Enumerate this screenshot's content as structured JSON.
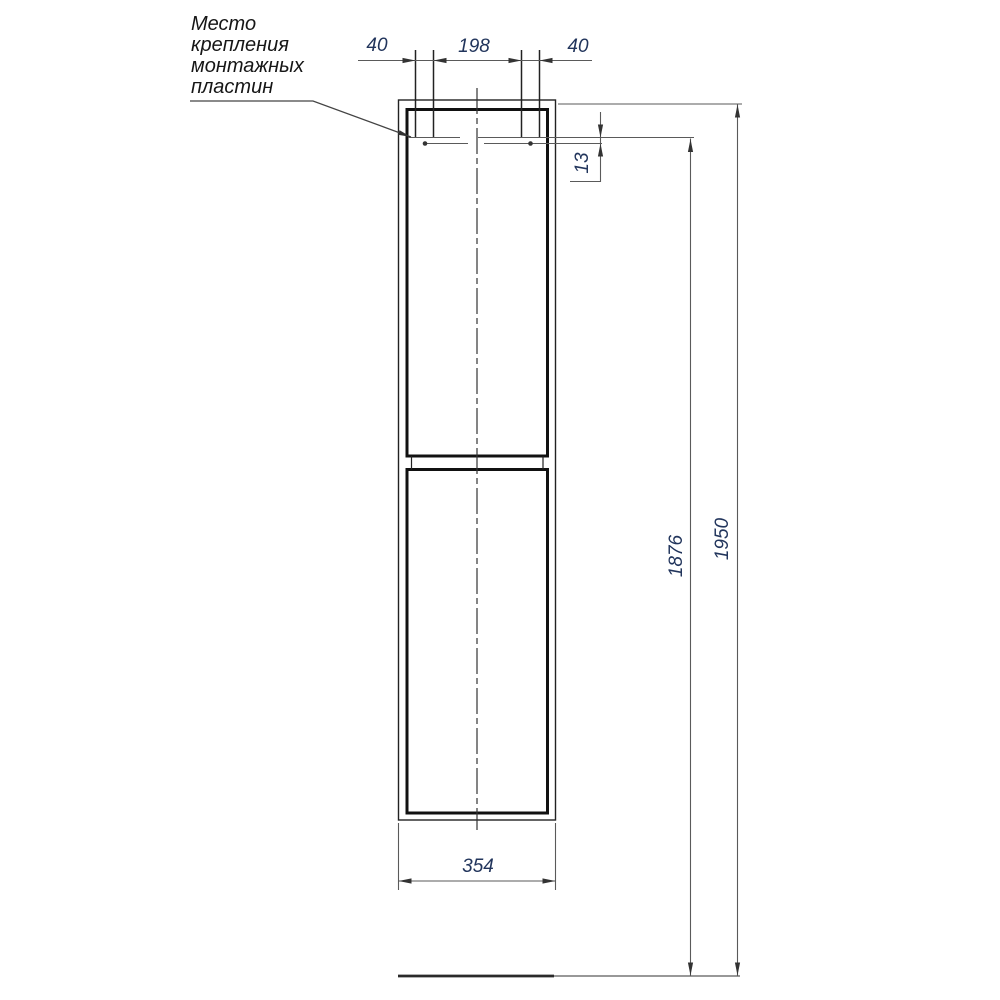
{
  "title": "Cabinet mounting technical drawing",
  "note": {
    "text": "Место\nкрепления\nмонтажных\nпластин"
  },
  "dimensions": {
    "plate_left_width": "40",
    "plate_spacing": "198",
    "plate_right_width": "40",
    "plate_vertical_offset": "13",
    "mounting_height": "1876",
    "total_height": "1950",
    "cabinet_width": "354"
  },
  "colors": {
    "dimension_text": "#22355c",
    "note_text": "#161616",
    "line": "#222222",
    "thick_line": "#111111",
    "dim_line": "#5a5a5a",
    "arrow": "#333333",
    "background": "#ffffff"
  }
}
